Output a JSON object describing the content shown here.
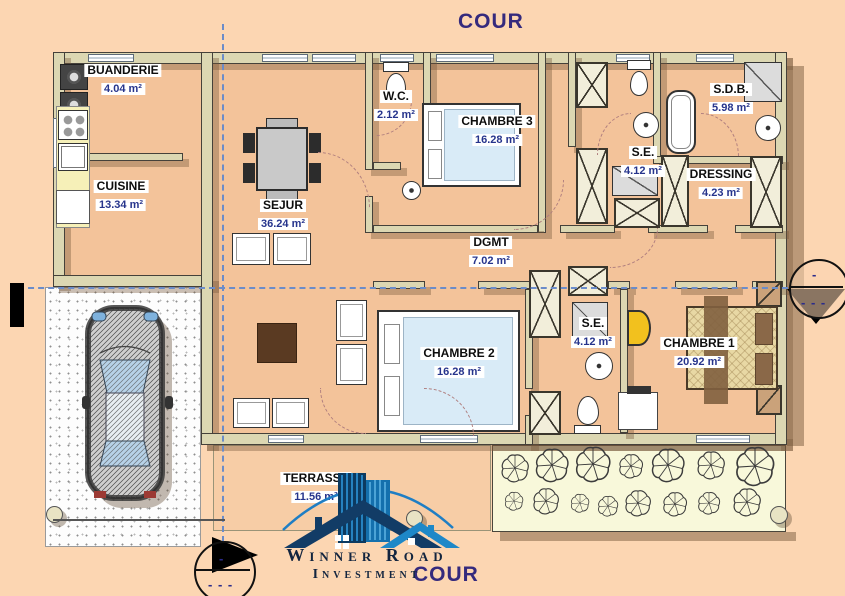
{
  "site": {
    "cour_top": "COUR",
    "cour_bottom": "COUR"
  },
  "rooms": [
    {
      "name": "BUANDERIE",
      "area": "4.04 m²"
    },
    {
      "name": "CUISINE",
      "area": "13.34 m²"
    },
    {
      "name": "SEJUR",
      "area": "36.24 m²"
    },
    {
      "name": "W.C.",
      "area": "2.12 m²"
    },
    {
      "name": "CHAMBRE 3",
      "area": "16.28 m²"
    },
    {
      "name": "S.E.",
      "area": "4.12 m²"
    },
    {
      "name": "S.D.B.",
      "area": "5.98 m²"
    },
    {
      "name": "DRESSING",
      "area": "4.23 m²"
    },
    {
      "name": "DGMT",
      "area": "7.02 m²"
    },
    {
      "name": "CHAMBRE 2",
      "area": "16.28 m²"
    },
    {
      "name": "S.E.",
      "area": "4.12 m²"
    },
    {
      "name": "CHAMBRE 1",
      "area": "20.92 m²"
    },
    {
      "name": "TERRASSE",
      "area": "11.56 m²"
    }
  ],
  "logo": {
    "line1": "Winner Road",
    "line2": "Investment"
  },
  "markers": {
    "dash_top": "-",
    "dash_bottom": "- - -"
  },
  "colors": {
    "background": "#fcd6b2",
    "floor": "#f3c39a",
    "wall": "#dcd7b2",
    "garden": "#f8f8da",
    "label_area_text": "#26348c",
    "cour_text": "#352a7d",
    "axis_blue": "#6b8cc9",
    "logo_blue": "#1470ad",
    "accent_yellow": "#f2c11e"
  }
}
